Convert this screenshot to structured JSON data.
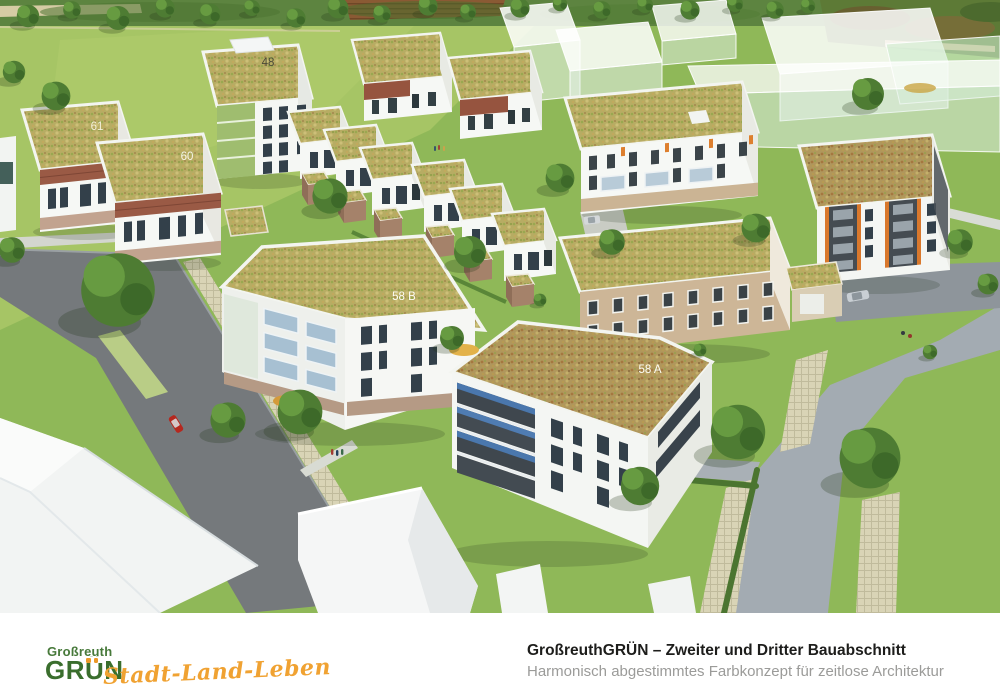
{
  "scene": {
    "roof_labels": {
      "b48": "48",
      "b61": "61",
      "b60": "60",
      "b58b": "58 B",
      "b58a": "58 A"
    }
  },
  "footer": {
    "logo": {
      "top": "Großreuth",
      "main": "GRÜN",
      "tagline": "Stadt-Land-Leben"
    },
    "caption_title": "GroßreuthGRÜN – Zweiter und Dritter Bauabschnitt",
    "caption_subtitle": "Harmonisch abgestimmtes Farbkonzept für zeitlose Architektur"
  },
  "palette": {
    "logo_green": "#3a6e2d",
    "logo_orange": "#ec9a28",
    "tagline_orange": "#f0a232",
    "caption_dark": "#1d1d1b",
    "caption_gray": "#9b9b99",
    "grass": "#8fb858",
    "sedum_roof": "#b7ac63",
    "road_dark": "#75797c",
    "road_light": "#a3abb2",
    "brick_accent": "#9a5a45",
    "orange_facade": "#d9782c"
  }
}
